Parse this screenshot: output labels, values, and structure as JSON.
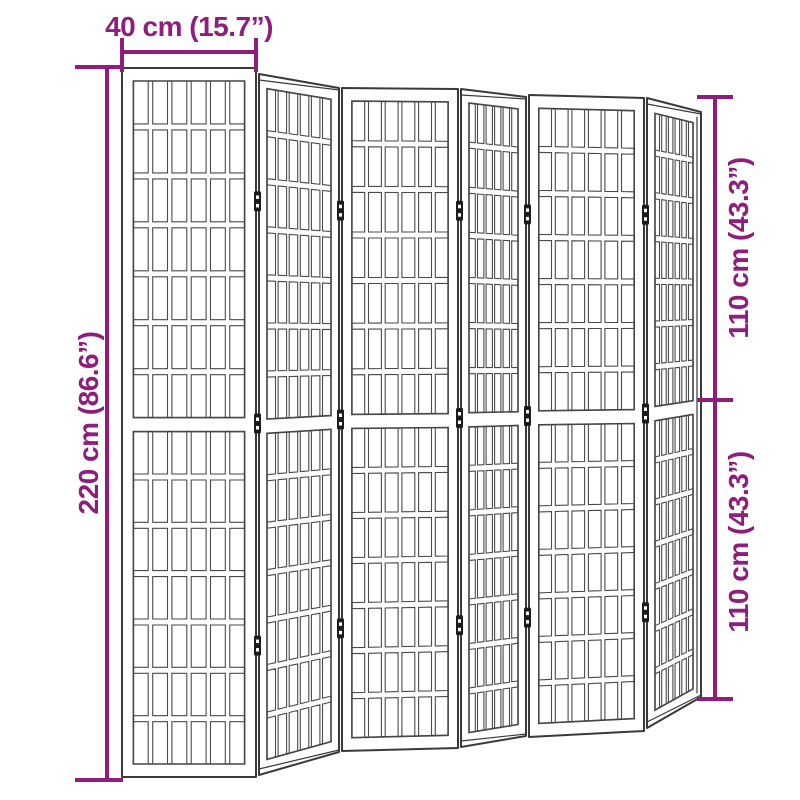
{
  "canvas": {
    "width": 800,
    "height": 800,
    "background": "#ffffff"
  },
  "colors": {
    "dimension": "#8F1D7B",
    "outline": "#3a3a3a",
    "lattice": "#4a4a4a",
    "hinge": "#1c1c1c",
    "panel_fill": "#ffffff"
  },
  "product": {
    "name": "folding-room-divider-6-panels",
    "lattice": {
      "columns": 6,
      "rows_per_section": 7,
      "sections": 2
    },
    "panels": [
      {
        "angled": false,
        "left": {
          "x": 122,
          "top": 68,
          "bottom": 777
        },
        "right": {
          "x": 256,
          "top": 68,
          "bottom": 777
        }
      },
      {
        "angled": true,
        "left": {
          "x": 259,
          "top": 74,
          "bottom": 775
        },
        "right": {
          "x": 339,
          "top": 88,
          "bottom": 752
        }
      },
      {
        "angled": false,
        "left": {
          "x": 342,
          "top": 88,
          "bottom": 751
        },
        "right": {
          "x": 458,
          "top": 89,
          "bottom": 748
        }
      },
      {
        "angled": true,
        "left": {
          "x": 461,
          "top": 89,
          "bottom": 747
        },
        "right": {
          "x": 526,
          "top": 97,
          "bottom": 736
        }
      },
      {
        "angled": false,
        "left": {
          "x": 529,
          "top": 95,
          "bottom": 737
        },
        "right": {
          "x": 644,
          "top": 98,
          "bottom": 731
        }
      },
      {
        "angled": true,
        "left": {
          "x": 647,
          "top": 98,
          "bottom": 728
        },
        "right": {
          "x": 701,
          "top": 112,
          "bottom": 697
        }
      }
    ],
    "hinges": {
      "boundaries": [
        {
          "x": 257.5,
          "top": 71,
          "bottom": 776
        },
        {
          "x": 340.5,
          "top": 88,
          "bottom": 751
        },
        {
          "x": 459.5,
          "top": 89,
          "bottom": 747
        },
        {
          "x": 527.5,
          "top": 96,
          "bottom": 736
        },
        {
          "x": 645.5,
          "top": 98,
          "bottom": 729
        }
      ],
      "positions": [
        0.185,
        0.5,
        0.815
      ]
    }
  },
  "dimensions": {
    "top": {
      "label": "40 cm (15.7”)",
      "line": [
        122,
        52,
        256,
        52
      ],
      "ticks": [
        [
          122,
          38,
          122,
          72
        ],
        [
          256,
          38,
          256,
          72
        ]
      ],
      "text": {
        "x": 189,
        "y": 36,
        "rotate": 0
      }
    },
    "left": {
      "label": "220 cm (86.6”)",
      "line": [
        107,
        67,
        107,
        780
      ],
      "ticks": [
        [
          75,
          67,
          123,
          67
        ],
        [
          75,
          780,
          123,
          780
        ]
      ],
      "text": {
        "x": 98,
        "y": 423,
        "rotate": -90
      }
    },
    "right_upper": {
      "label": "110 cm (43.3”)",
      "line": [
        715,
        97,
        715,
        400
      ],
      "ticks": [
        [
          697,
          97,
          733,
          97
        ],
        [
          697,
          400,
          733,
          400
        ]
      ],
      "text": {
        "x": 748,
        "y": 248,
        "rotate": -90
      }
    },
    "right_lower": {
      "label": "110 cm (43.3”)",
      "line": [
        715,
        400,
        715,
        699
      ],
      "ticks": [
        [
          697,
          699,
          733,
          699
        ]
      ],
      "text": {
        "x": 748,
        "y": 542,
        "rotate": -90
      }
    }
  }
}
